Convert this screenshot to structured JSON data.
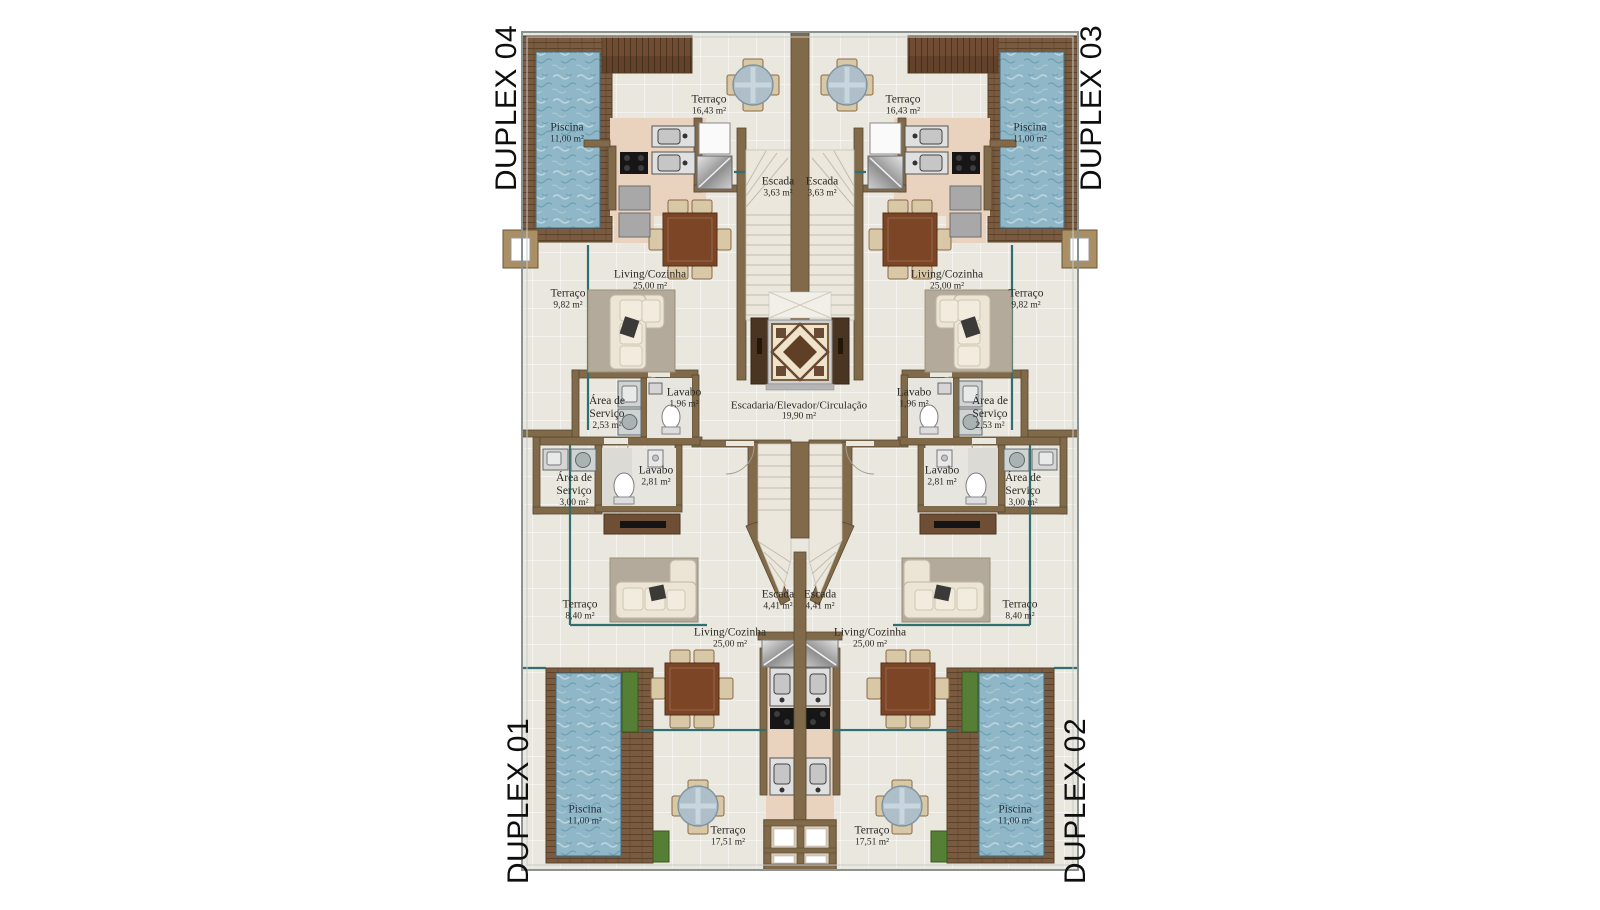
{
  "plan": {
    "type": "architectural-floor-plan",
    "units": [
      {
        "id": "duplex-04",
        "label": "DUPLEX 04"
      },
      {
        "id": "duplex-03",
        "label": "DUPLEX 03"
      },
      {
        "id": "duplex-01",
        "label": "DUPLEX 01"
      },
      {
        "id": "duplex-02",
        "label": "DUPLEX 02"
      }
    ],
    "rooms": [
      {
        "name": "Piscina",
        "area": "11,00 m²"
      },
      {
        "name": "Terraço",
        "area": "16,43 m²"
      },
      {
        "name": "Terraço",
        "area": "16,43 m²"
      },
      {
        "name": "Piscina",
        "area": "11,00 m²"
      },
      {
        "name": "Escada",
        "area": "3,63 m²"
      },
      {
        "name": "Escada",
        "area": "3,63 m²"
      },
      {
        "name": "Living/Cozinha",
        "area": "25,00 m²"
      },
      {
        "name": "Living/Cozinha",
        "area": "25,00 m²"
      },
      {
        "name": "Terraço",
        "area": "9,82 m²"
      },
      {
        "name": "Terraço",
        "area": "9,82 m²"
      },
      {
        "name": "Lavabo",
        "area": "1,96 m²"
      },
      {
        "name": "Lavabo",
        "area": "1,96 m²"
      },
      {
        "name": "Área de Serviço",
        "area": "2,53 m²"
      },
      {
        "name": "Área de Serviço",
        "area": "2,53 m²"
      },
      {
        "name": "Escadaria/Elevador/Circulação",
        "area": "19,90 m²"
      },
      {
        "name": "Área de Serviço",
        "area": "3,00 m²"
      },
      {
        "name": "Área de Serviço",
        "area": "3,00 m²"
      },
      {
        "name": "Lavabo",
        "area": "2,81 m²"
      },
      {
        "name": "Lavabo",
        "area": "2,81 m²"
      },
      {
        "name": "Escada",
        "area": "4,41 m²"
      },
      {
        "name": "Escada",
        "area": "4,41 m²"
      },
      {
        "name": "Terraço",
        "area": "8,40 m²"
      },
      {
        "name": "Terraço",
        "area": "8,40 m²"
      },
      {
        "name": "Living/Cozinha",
        "area": "25,00 m²"
      },
      {
        "name": "Living/Cozinha",
        "area": "25,00 m²"
      },
      {
        "name": "Piscina",
        "area": "11,00 m²"
      },
      {
        "name": "Piscina",
        "area": "11,00 m²"
      },
      {
        "name": "Terraço",
        "area": "17,51 m²"
      },
      {
        "name": "Terraço",
        "area": "17,51 m²"
      }
    ],
    "colors": {
      "floor": "#eae7de",
      "wall": "#806a4a",
      "wood_deck": "#7a5a40",
      "pool_water": "#8fb7c8",
      "glass_line": "#2f6f6f",
      "kitchen_counter": "#e9d2be",
      "rug": "#b3aa9c",
      "dining_table": "#7c4526",
      "label_text": "#2b2924"
    }
  }
}
